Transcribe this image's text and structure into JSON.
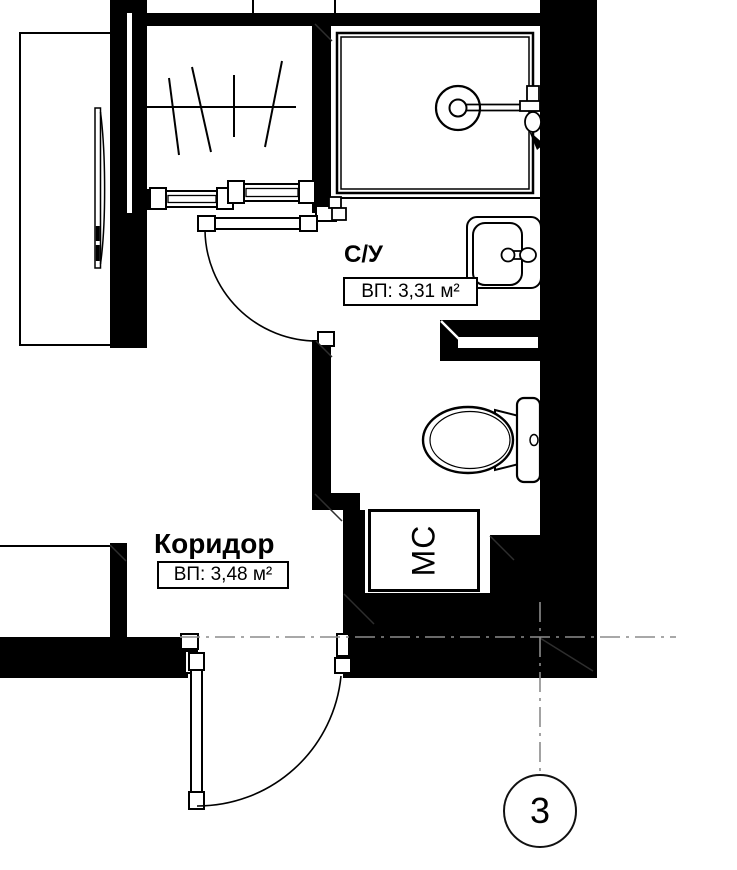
{
  "plan": {
    "rooms": [
      {
        "name": "С/У",
        "area": "ВП: 3,31 м²"
      },
      {
        "name": "Коридор",
        "area": "ВП: 3,48 м²"
      }
    ],
    "appliances": {
      "washing_machine": "МС"
    },
    "axis_marker": {
      "number": "3"
    },
    "fixtures": [
      "shower-tray",
      "shower-mixer-icon",
      "washbasin-icon",
      "toilet-icon",
      "vent-duct-icon",
      "wardrobe-hangers-icon",
      "sliding-wardrobe-doors",
      "door-swing",
      "mirror-panel-icon"
    ],
    "colors": {
      "wall": "#000000",
      "background": "#ffffff",
      "axis_line": "#8c8c8c",
      "outline": "#000000"
    }
  }
}
